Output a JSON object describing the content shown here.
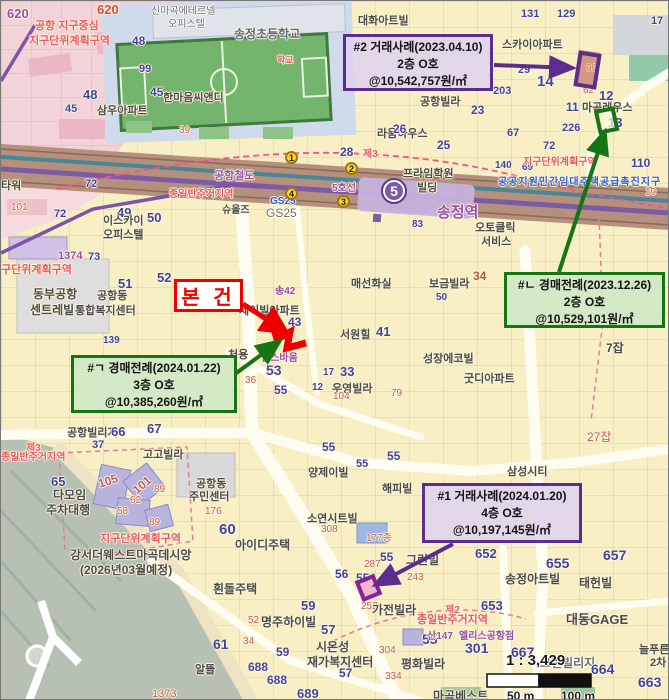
{
  "colors": {
    "purple_accent": "#5b2d8e",
    "green_accent": "#157515",
    "red_accent": "#ee0000",
    "line5_purple": "#7d5aa6"
  },
  "callouts": {
    "case2": {
      "line1": "#2 거래사례(2023.04.10)",
      "line2": "2층 O호",
      "line3": "@10,542,757원/㎡"
    },
    "auction_n": {
      "line1": "#ㄴ 경매전례(2023.12.26)",
      "line2": "2층 O호",
      "line3": "@10,529,101원/㎡"
    },
    "auction_g": {
      "line1": "#ㄱ 경매전례(2024.01.22)",
      "line2": "3층 O호",
      "line3": "@10,385,260원/㎡"
    },
    "case1": {
      "line1": "#1 거래사례(2024.01.20)",
      "line2": "4층 O호",
      "line3": "@10,197,145원/㎡"
    },
    "subject": {
      "label": "본 건"
    }
  },
  "scale": {
    "ratio": "1 : 3,429",
    "half": "50 m",
    "full": "100 m"
  },
  "transit": {
    "line5_badge": "5",
    "station": "송정역",
    "line5": "5호선",
    "rail": "공항철도",
    "stops": [
      "1",
      "2",
      "3",
      "4"
    ]
  },
  "labels": {
    "p620a": "620",
    "p620b": "620",
    "gonghang_center": "공항 지구중심",
    "jigudanwi1": "지구단위계획구역",
    "sinmagok": "신마곡에테르넬",
    "opistel1": "오피스텔",
    "hanmaum": "한마음씨앤디",
    "samwoo": "삼우아파트",
    "n48a": "48",
    "n99p": "99",
    "n48b": "48",
    "n45a": "45",
    "n45b": "45",
    "n39r": "39",
    "n1373": "1373",
    "school": "송정초등학교",
    "hakgyo": "학교",
    "daehwa": "대화아트빌",
    "gonghangvilla": "공항빌라",
    "raum": "라움하우스",
    "n23": "23",
    "n25": "25",
    "n26": "26",
    "sky": "스카이아파트",
    "magokreus": "마곡레우스",
    "n131": "131",
    "n129": "129",
    "n17a": "17",
    "n29a": "29",
    "n99r": "99",
    "n62r": "62",
    "n14": "14",
    "n12a": "12",
    "n11a": "11",
    "n13": "13",
    "n203": "203",
    "n226": "226",
    "n67a": "67",
    "n72a": "72",
    "n140": "140",
    "n69": "69",
    "n110": "110",
    "n19r": "19",
    "jigudanwi2": "지구단위계획구역",
    "gonggong": "공공지원민간임대주택공급촉진지구",
    "prime": "프라임학원",
    "bilding": "빌딩",
    "n28": "28",
    "je3a": "제3",
    "jongil1": "종일반주거지역",
    "gs25a": "GS25",
    "gs25b": "GS25",
    "syu": "슈올즈",
    "tower": "타워",
    "n101p": "101",
    "n72c": "72",
    "n72d": "72",
    "n49": "49",
    "n50a": "50",
    "iskai": "이스카이",
    "opistel2": "오피스텔",
    "n1374": "1374",
    "gudanwi": "구단위계획구역",
    "dongbu": "동부공항",
    "centre": "센트레빌",
    "gonghangdong1": "공항동",
    "tonghap": "통합복지센터",
    "n73": "73",
    "n51": "51",
    "n52a": "52",
    "n139": "139",
    "jeilbil": "제이빌아파트",
    "song42": "송42",
    "n43": "43",
    "n53": "53",
    "n55a": "55",
    "n36r": "36",
    "cheoyong": "처용",
    "wells": "웰스바움",
    "seowon": "서원힐",
    "n41": "41",
    "maeseon": "매선화실",
    "bogeum": "보금빌라",
    "n34a": "34",
    "n50b": "50",
    "auto": "오토클릭",
    "service": "서비스",
    "n83": "83",
    "sungjang": "성장에코빌",
    "gooddi": "굿디아파트",
    "wooyoung": "우영빌라",
    "n33": "33",
    "n17b": "17",
    "n12b": "12",
    "n104": "104",
    "n79": "79",
    "n7jab": "7잡",
    "n27jab": "27잡",
    "gonghangvillige": "공항빌리지",
    "n66": "66",
    "n67c": "67",
    "n37": "37",
    "gogo": "고고빌라",
    "n65": "65",
    "n105": "105",
    "n101b": "101",
    "n89a": "89",
    "n62c": "62",
    "n58": "58",
    "n89b": "89",
    "damoim": "다모임",
    "jucha": "주차대행",
    "jigudanwi3": "지구단위계획구역",
    "gangseo": "강서더웨스트마곡데시앙",
    "yejeong": "(2026년03월예정)",
    "je3b": "제3",
    "jongil2": "종일반주거지역",
    "gonghangdong2": "공항동",
    "jumin": "주민센터",
    "n176": "176",
    "n60": "60",
    "aidi": "아이디주택",
    "n55b": "55",
    "n55c2": "55",
    "n55d2": "55",
    "yang": "양제이빌",
    "haepibil": "해피빌",
    "soyeon": "소연시트빌",
    "n308": "308",
    "n177": "177종",
    "samsung": "삼성시티",
    "huindol": "흰돌주택",
    "myeongju": "명주하이빌",
    "n59a": "59",
    "n52r": "52",
    "n61": "61",
    "n34r": "34",
    "alddeul": "알뜰",
    "n688a": "688",
    "n688b": "688",
    "n59b": "59",
    "sion": "시온성",
    "jaega": "재가복지센터",
    "n57a": "57",
    "n57b": "57",
    "pyeong": "평화빌라",
    "n55e": "55",
    "n301": "301",
    "n334": "334",
    "n304": "304",
    "n252": "252",
    "magokbest": "마곡베스트",
    "n689": "689",
    "gajeon": "가전빌라",
    "je2": "제2",
    "jongil3": "종일반주거지역",
    "san147": "산147",
    "ellis": "엘리스공항점",
    "greenbil": "그린빌",
    "n55f": "55",
    "n287": "287",
    "n243": "243",
    "n56": "56",
    "n55g": "55",
    "songart": "송정아트빌",
    "taehyun": "태헌빌",
    "daedong": "대동GAGE",
    "greenvil2": "그린빌리지",
    "neul": "늘푸른벽",
    "icha": "2차",
    "n652": "652",
    "n655": "655",
    "n657": "657",
    "n653": "653",
    "n667": "667",
    "n664": "664",
    "n663": "663"
  }
}
